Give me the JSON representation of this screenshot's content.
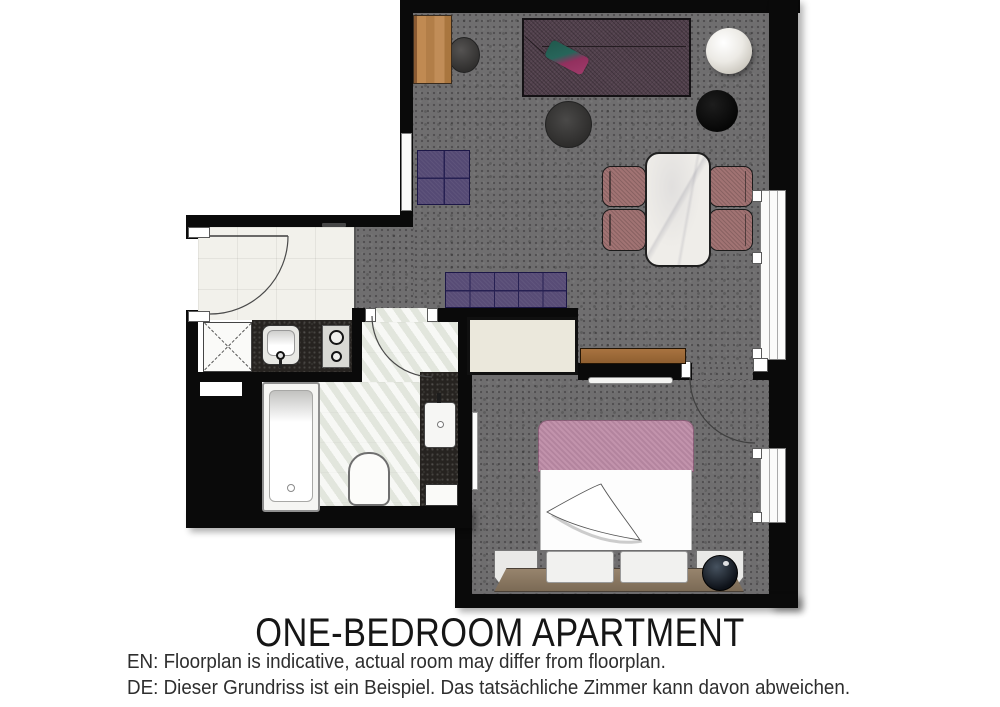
{
  "title": "ONE-BEDROOM APARTMENT",
  "disclaimers": {
    "en": "EN: Floorplan is indicative, actual room may differ from floorplan.",
    "de": "DE: Dieser Grundriss ist ein Beispiel. Das tatsächliche Zimmer kann davon abweichen."
  },
  "palette": {
    "wall": "#0a0a0a",
    "carpet_gray": "#6f6e6f",
    "entry_tile": "#f2f1eb",
    "bath_tile": "#edefe9",
    "sofa_plum": "#51404c",
    "purple_accent": "#554a74",
    "chair_rose": "#a17373",
    "bed_blanket_pink": "#bd8ba6",
    "wood": "#b3804e",
    "marble": "#efede9",
    "counter_dark": "#262320"
  },
  "areas": [
    "living-dining-area",
    "bedroom",
    "bathroom",
    "entry-hall-kitchenette"
  ],
  "furniture": [
    "corner-sofa",
    "throw-pillow",
    "round-side-table-white",
    "round-side-table-black",
    "pouf",
    "square-ottoman",
    "upholstered-bench",
    "dining-table-marble",
    "dining-chairs-x4",
    "console-desk",
    "stool",
    "wardrobe",
    "wall-shelf-desk",
    "wall-rail",
    "double-bed",
    "nightstand-left",
    "nightstand-right",
    "table-lamp",
    "washer-unit",
    "kitchen-sink",
    "two-burner-hob",
    "bathtub",
    "toilet",
    "vanity-basin",
    "mirror",
    "windows-x3",
    "doors-x3"
  ]
}
